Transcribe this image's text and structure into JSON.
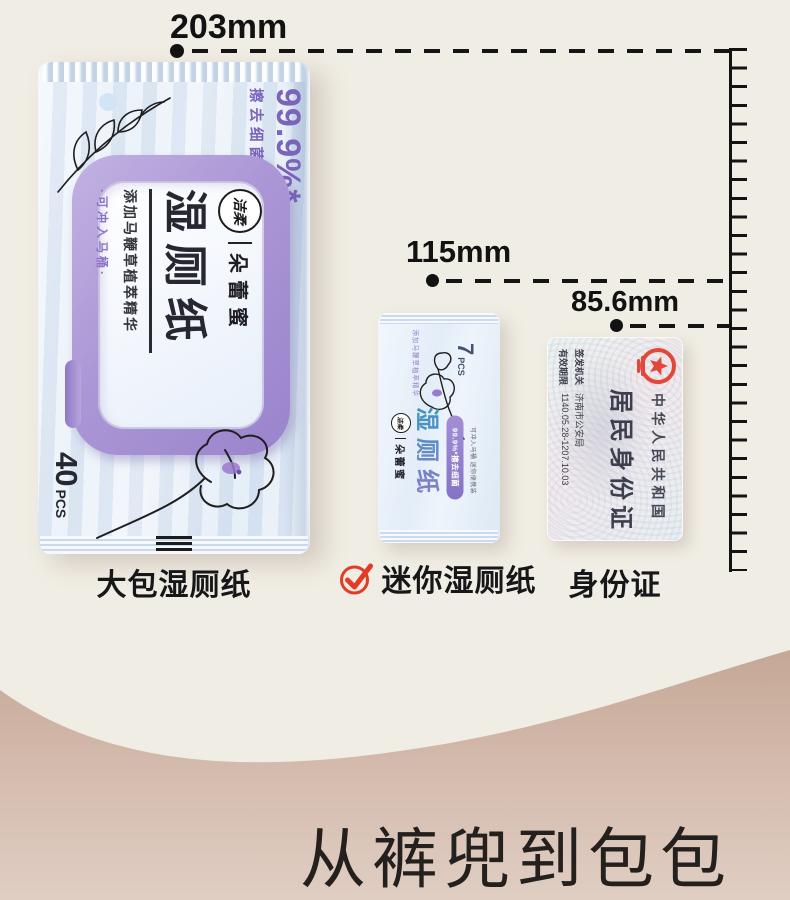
{
  "measurements": {
    "large": "203mm",
    "mini": "115mm",
    "card": "85.6mm"
  },
  "labels": {
    "large": "大包湿厕纸",
    "mini": "迷你湿厕纸",
    "card": "身份证"
  },
  "headline": {
    "text": "从裤兜到包包"
  },
  "large_pack": {
    "badge_percent": "99.9%*",
    "badge_sub": "擦去细菌",
    "brand": "洁柔",
    "series": "朵蕾蜜",
    "product": "湿厕纸",
    "tagline": "添加马鞭草植萃精华",
    "flushable": "·可冲入马桶·",
    "count": "40",
    "count_unit": "PCS"
  },
  "mini_pack": {
    "tagline": "添加马鞭草植萃精华",
    "count": "7",
    "count_unit": "PCS",
    "brand": "洁柔",
    "series": "朵蕾蜜",
    "product": "湿厕纸",
    "badge": "99.9%*擦去细菌",
    "portable": "可冲入马桶 迷你便携装"
  },
  "id_card": {
    "country": "中华人民共和国",
    "title": "居民身份证",
    "issuer_label": "签发机关",
    "issuer": "济南市公安局",
    "validity_label": "有效期限",
    "validity": "1140.05.28-1207.10.03"
  },
  "colors": {
    "background_top": "#f0ede4",
    "wave_tan": "#c6a897",
    "accent_purple": "#8a72c4",
    "lid_purple": "#a78fd3",
    "check_red": "#e23c26",
    "emblem_red": "#e2473a",
    "ink": "#141414"
  }
}
